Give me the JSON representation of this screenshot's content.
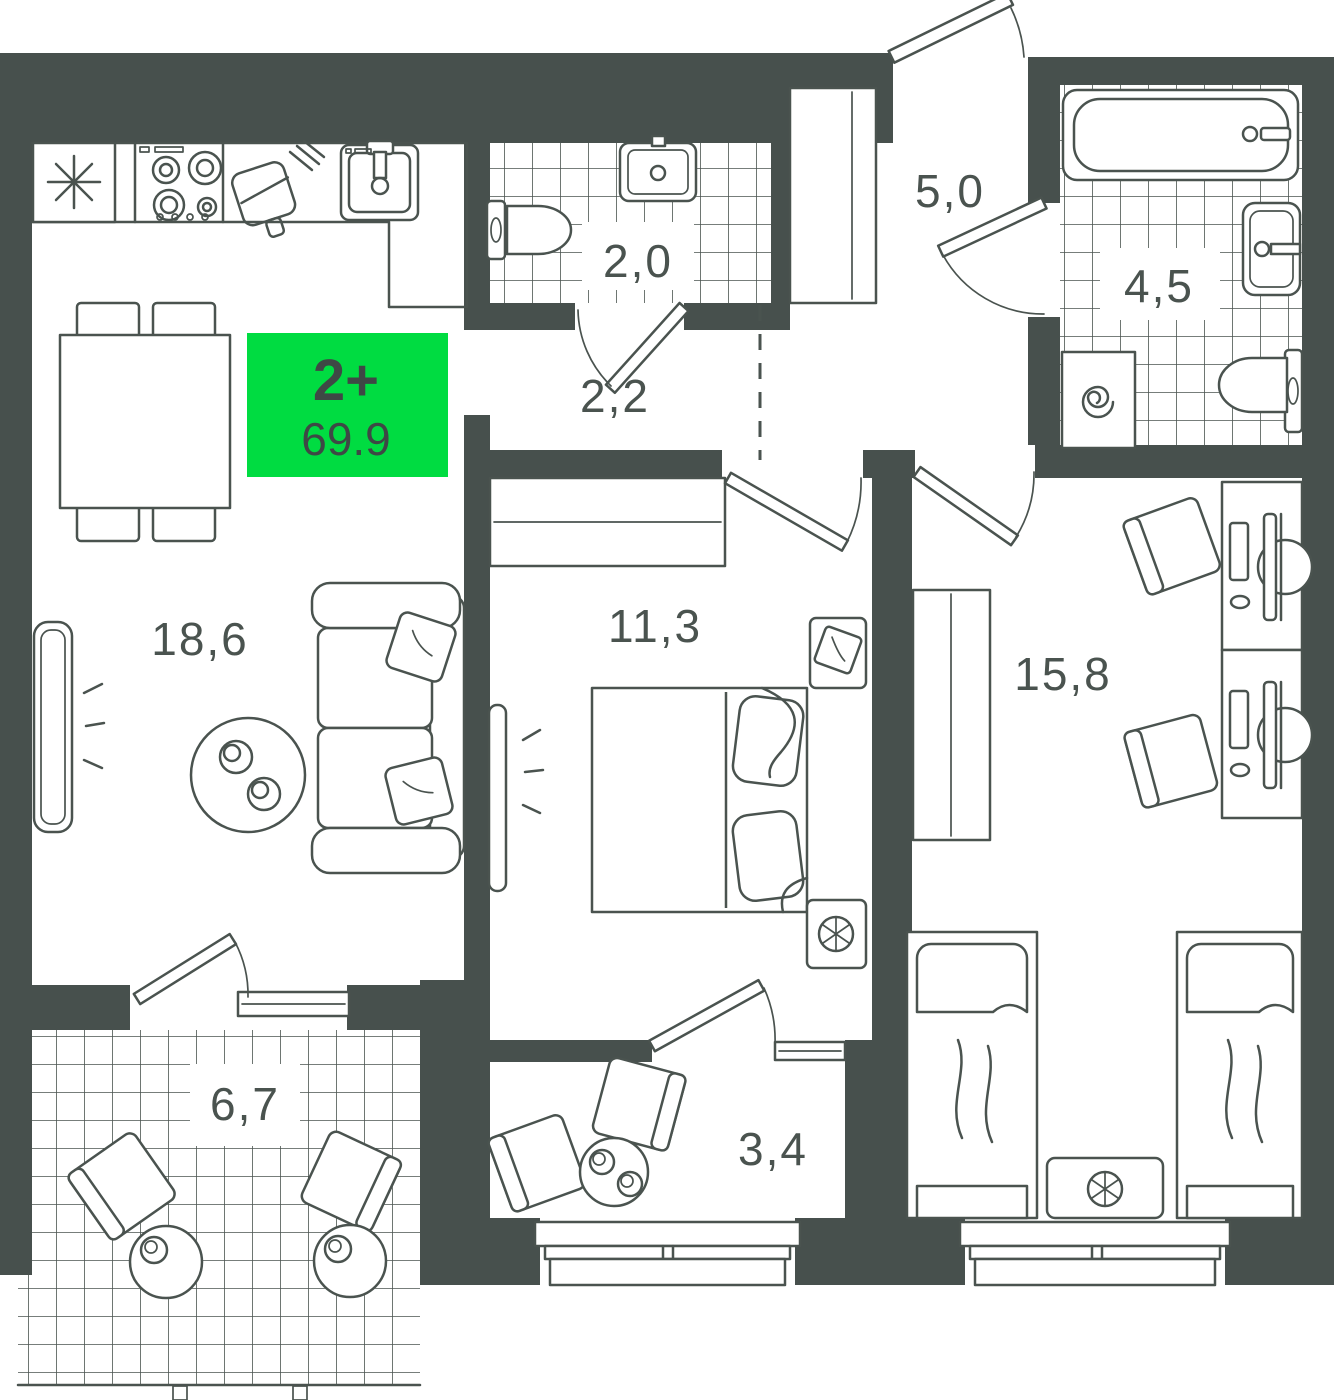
{
  "plan": {
    "title": "apartment floor plan",
    "badge": {
      "label": "2+",
      "area": "69.9"
    },
    "rooms": [
      {
        "name": "kitchen-living-room",
        "area": "18,6"
      },
      {
        "name": "bathroom-small",
        "area": "2,0"
      },
      {
        "name": "corridor",
        "area": "2,2"
      },
      {
        "name": "hallway",
        "area": "5,0"
      },
      {
        "name": "bathroom",
        "area": "4,5"
      },
      {
        "name": "bedroom",
        "area": "11,3"
      },
      {
        "name": "bedroom-second",
        "area": "15,8"
      },
      {
        "name": "loggia",
        "area": "6,7"
      },
      {
        "name": "loggia-second",
        "area": "3,4"
      }
    ],
    "colors": {
      "wall": "#47504D",
      "line": "#4A534F",
      "floor": "#FFFFFF",
      "badge": "#00DC41",
      "badge_text": "#3E4845"
    }
  }
}
